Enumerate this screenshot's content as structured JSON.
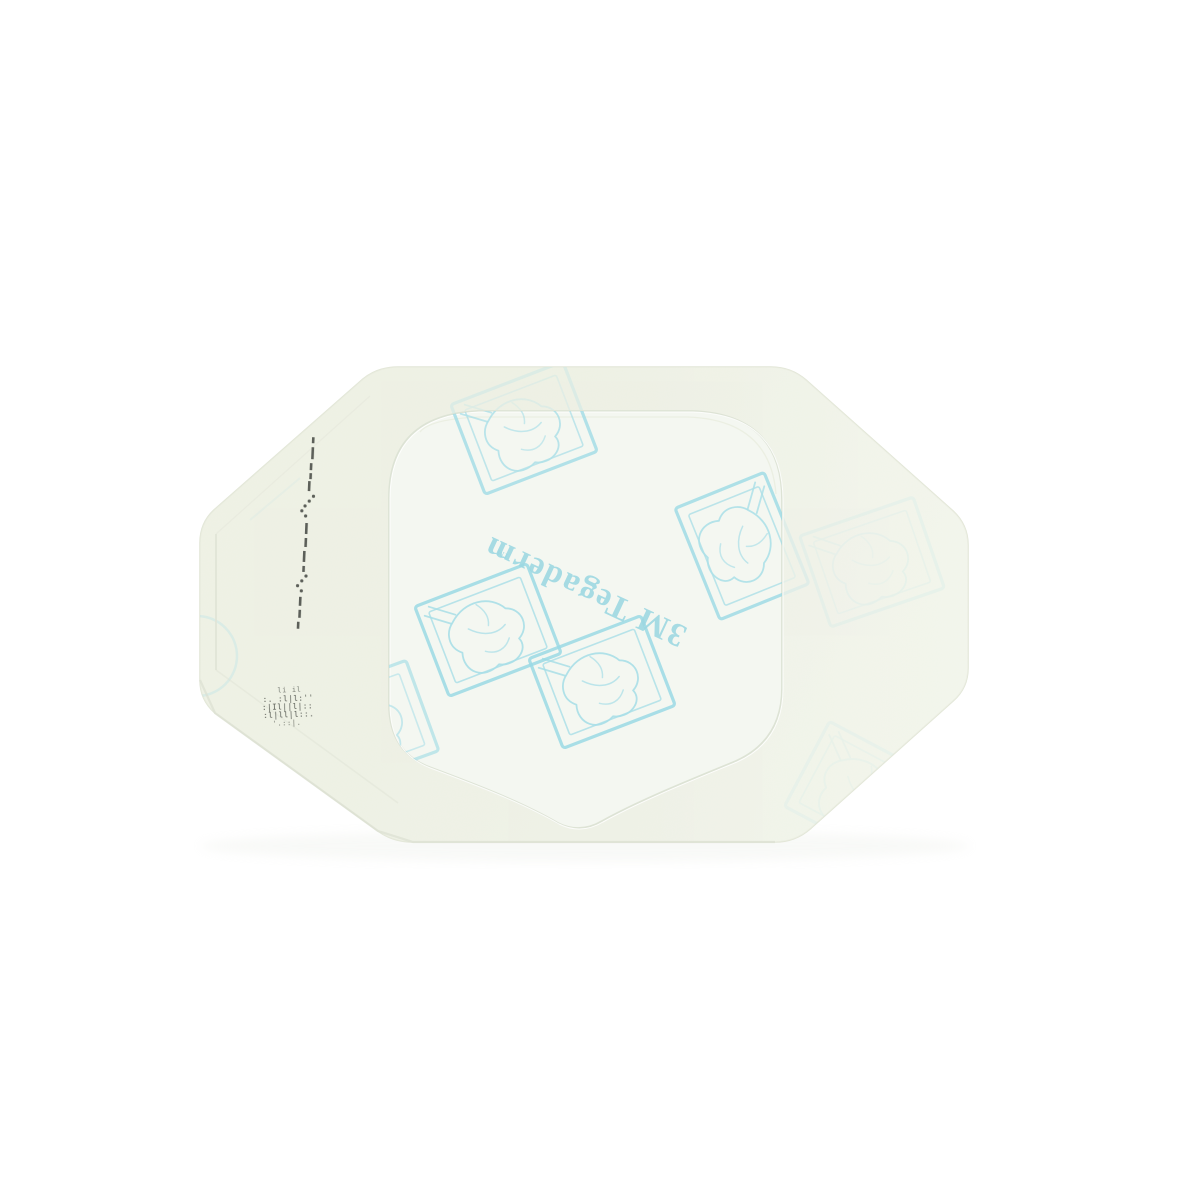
{
  "photo": {
    "frame_icon_name": "gloved-hand-picture-frame-icon",
    "marks_name": "registration-dash-marks",
    "microprint_name": "lot-code-microprint"
  },
  "print": {
    "brand_text": "3M Tegaderm",
    "trademark_symbol": "™",
    "microprint_rows": [
      "li   il",
      ":. :l|l:''",
      ":|Il||l|::",
      ":l|ll|l::.",
      "'.::|."
    ]
  },
  "colors": {
    "background": "#ffffff",
    "dressing_fill": "#eff2e6",
    "dressing_fill_light": "#f2f5ec",
    "dressing_edge": "#e2e6d7",
    "dressing_shadow": "#d8dcd0",
    "window_fill": "#f4f7f1",
    "window_edge": "#dde3d5",
    "print_teal": "#a9dfe8",
    "print_teal_bright": "#9bdae5",
    "microprint_ink": "#3c413a"
  }
}
